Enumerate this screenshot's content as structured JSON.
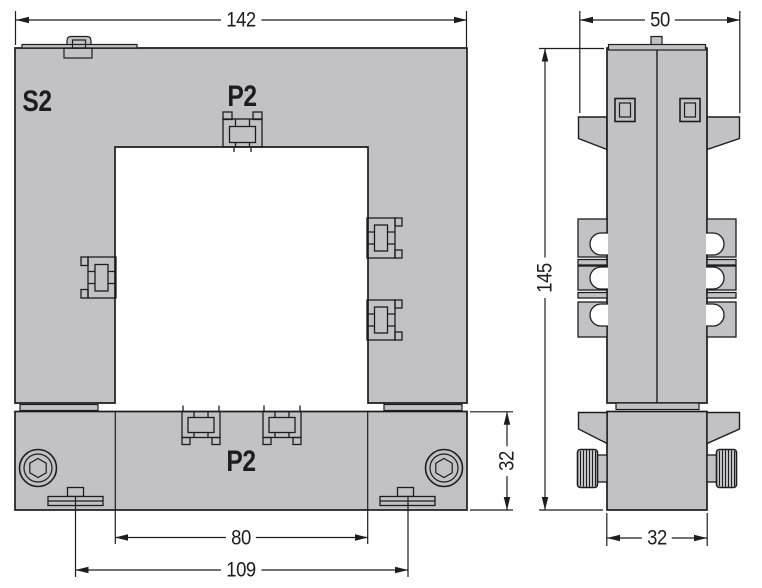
{
  "drawing": {
    "kind": "technical-dimension-drawing",
    "front_view": {
      "terminal_labels": {
        "s2": "S2",
        "p2_top": "P2",
        "p2_bottom": "P2"
      },
      "dimensions": {
        "overall_width": "142",
        "window_width": "80",
        "feet_spacing": "109",
        "bottom_bar_height": "32"
      }
    },
    "side_view": {
      "dimensions": {
        "overall_width": "50",
        "overall_height": "145",
        "body_depth": "32"
      }
    },
    "colors": {
      "body_fill": "#c2c2c4",
      "line": "#1d1d1f",
      "background": "#ffffff"
    }
  }
}
